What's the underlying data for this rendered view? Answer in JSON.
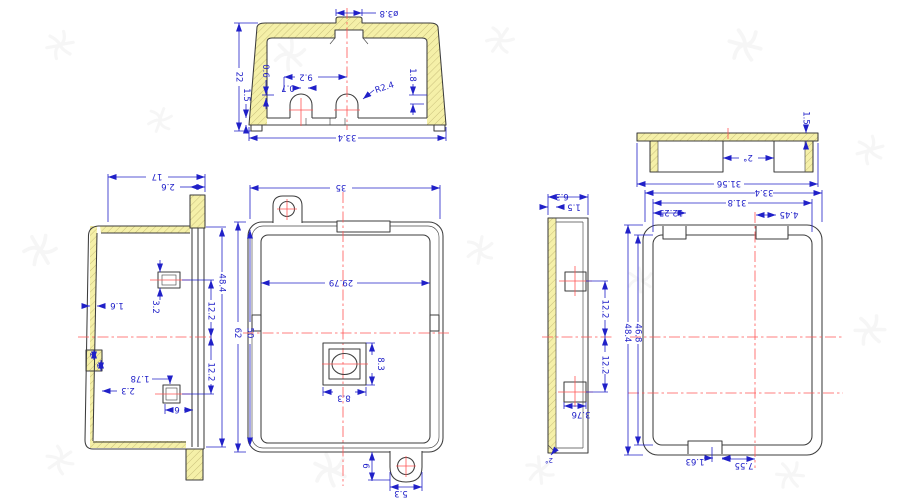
{
  "drawing": {
    "colors": {
      "dimension": "#2020c8",
      "outline": "#3d3d3d",
      "centerline": "#ff5555",
      "section_fill": "#f5f0a8",
      "section_hatch": "#c9c07c",
      "watermark": "#9a9a9a"
    },
    "views": {
      "section": {
        "dims": {
          "boss_dia": "ø3.8",
          "height": "22",
          "rim": "1.5",
          "step_left": "0.6",
          "bump_spacing": "9.2",
          "offset": "0.7",
          "radius": "R2.4",
          "step_right": "1.8",
          "width": "33.4"
        }
      },
      "bottom_edge": {
        "dims": {
          "thickness": "1.5",
          "draft": "2°",
          "width": "31.56"
        }
      },
      "left_side": {
        "dims": {
          "depth": "17",
          "tab": "2.6",
          "wall": "1.6",
          "clip_h": "3.2",
          "upper": "12.2",
          "height": "48.4",
          "lower": "12.2",
          "notch_a": "2",
          "notch_b": "2",
          "notch_off": "2.3",
          "clip_w": "1.78",
          "clip_off": "6"
        }
      },
      "front": {
        "dims": {
          "width": "35",
          "inner_width": "29.79",
          "height": "62",
          "inner_height": "50",
          "square_h": "8.3",
          "square_w": "8.3",
          "tab_h": "6",
          "tab_w": "5.3"
        }
      },
      "right_edge": {
        "dims": {
          "depth": "6.3",
          "wall": "1.5",
          "upper": "12.2",
          "lower": "12.2",
          "clip_w": "3.76",
          "draft": "2°"
        }
      },
      "right_section": {
        "dims": {
          "width": "33.4",
          "inner_width": "31.8",
          "slot_left": "12.25",
          "slot_right": "4.45",
          "height": "48.4",
          "inner_height": "46.8",
          "notch_w": "1.63",
          "notch_off": "7.55"
        }
      }
    }
  }
}
